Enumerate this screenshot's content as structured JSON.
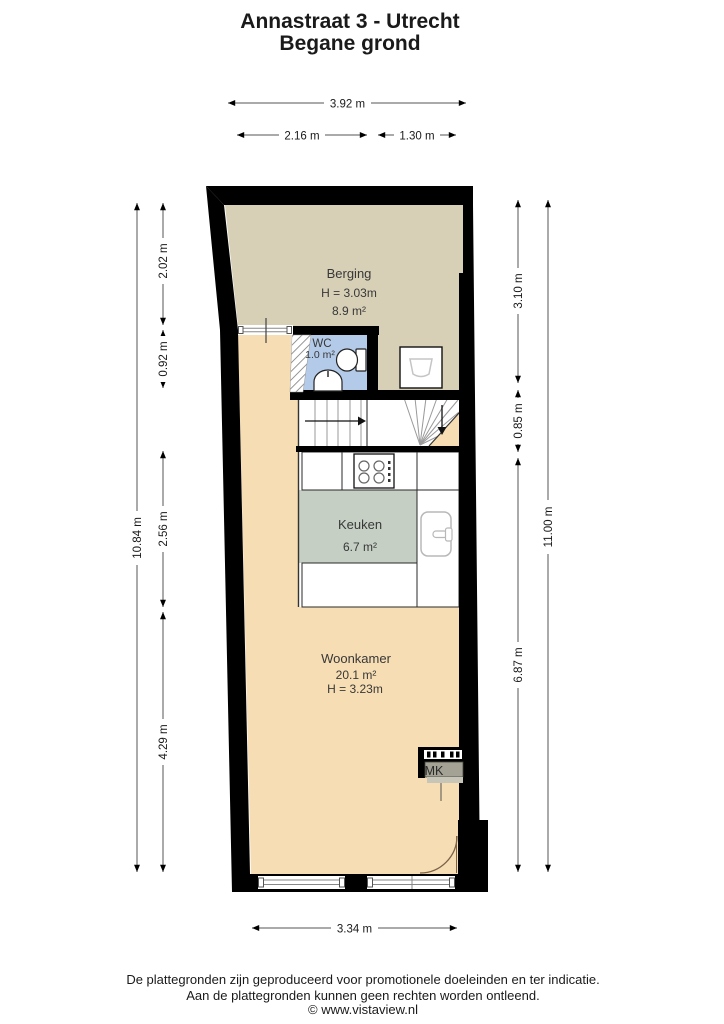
{
  "title": {
    "line1": "Annastraat 3 - Utrecht",
    "line2": "Begane grond"
  },
  "rooms": {
    "berging": {
      "name": "Berging",
      "ceiling_height": "H = 3.03m",
      "area": "8.9 m²"
    },
    "wc": {
      "name": "WC",
      "area": "1.0 m²"
    },
    "keuken": {
      "name": "Keuken",
      "area": "6.7 m²"
    },
    "woonkamer": {
      "name": "Woonkamer",
      "area": "20.1 m²",
      "ceiling_height": "H = 3.23m"
    },
    "meterkast": {
      "name": "MK"
    }
  },
  "dimensions": {
    "top_total": "3.92 m",
    "top_left_segment": "2.16 m",
    "top_right_segment": "1.30 m",
    "left_total": "10.84 m",
    "left_segments": [
      "2.02 m",
      "0.92 m",
      "2.56 m",
      "4.29 m"
    ],
    "right_segments": [
      "3.10 m",
      "0.85 m",
      "6.87 m"
    ],
    "right_total": "11.00 m",
    "bottom_total": "3.34 m"
  },
  "footer": {
    "line1": "De plattegronden zijn geproduceerd voor promotionele doeleinden en ter indicatie.",
    "line2": "Aan de plattegronden kunnen geen rechten worden ontleend.",
    "line3": "© www.vistaview.nl"
  },
  "colors": {
    "wall": "#000000",
    "berging_floor": "#d7d0b6",
    "wc_floor": "#b3cae8",
    "keuken_floor": "#c5cfc4",
    "woonkamer_floor": "#f6ddb3",
    "door_swing": "#7a6148"
  }
}
